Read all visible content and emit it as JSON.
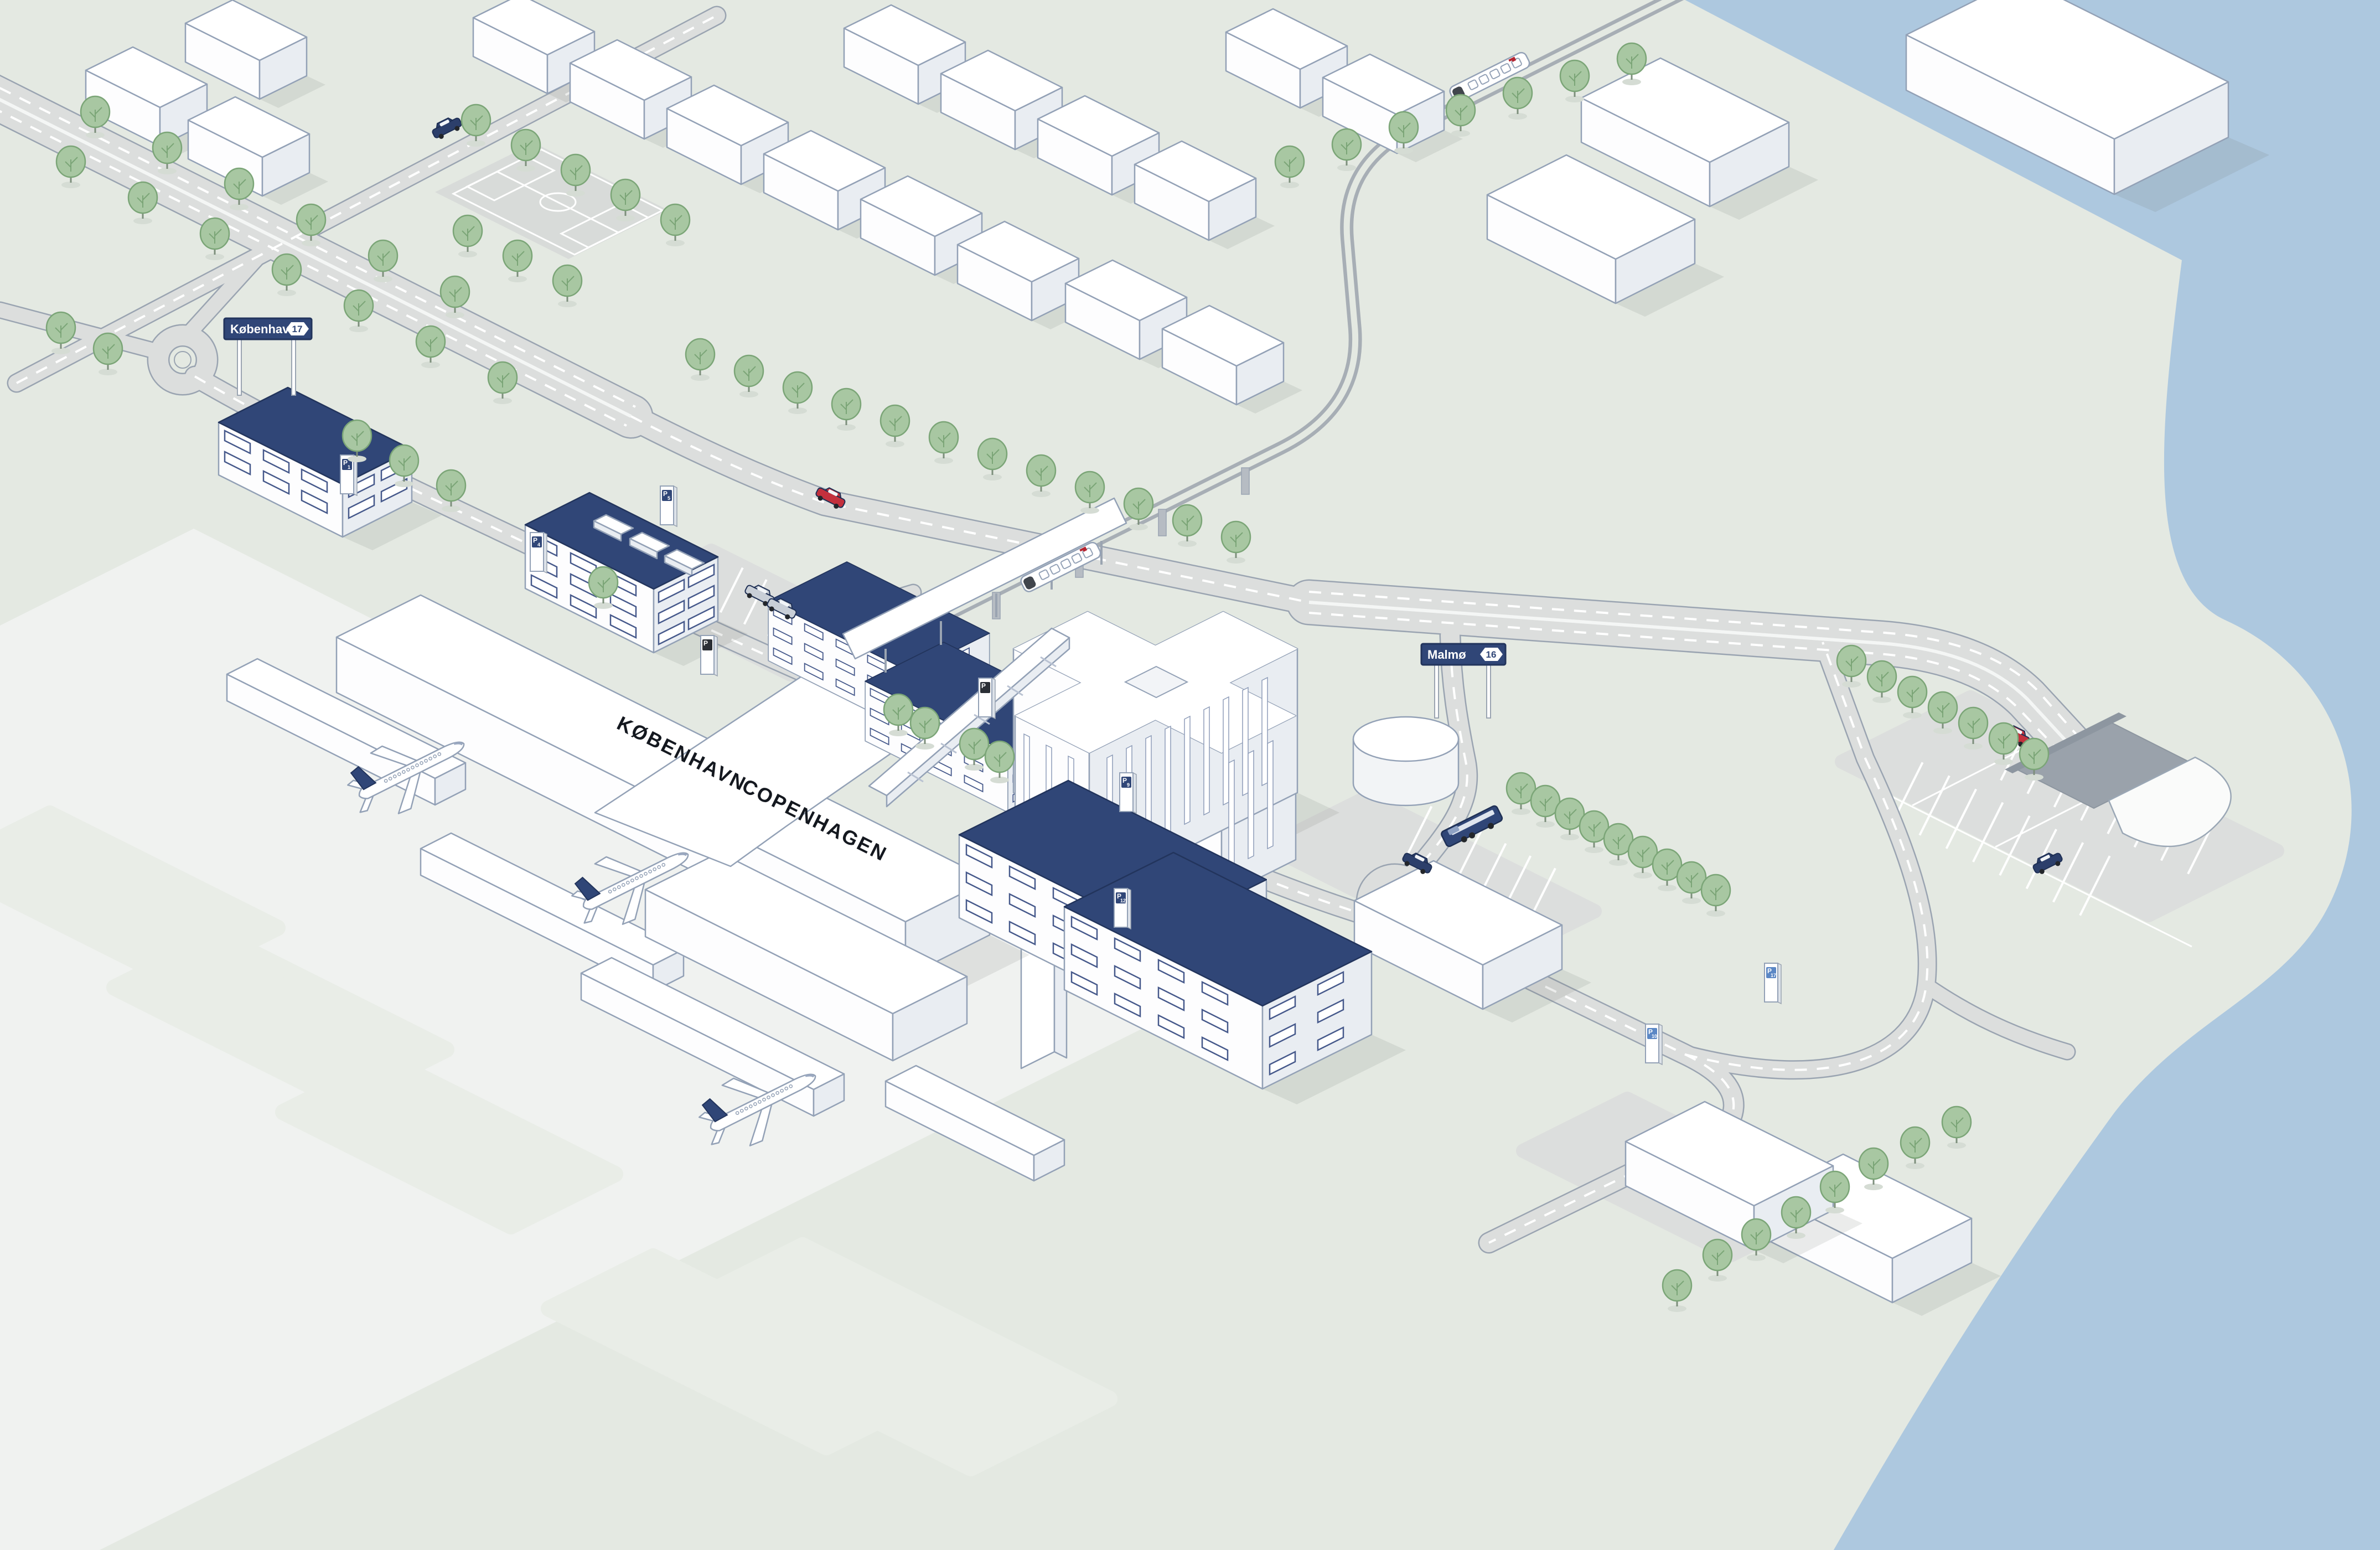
{
  "map": {
    "description": "isometric illustration of Copenhagen airport, city access roads, railway and Øresund coastline"
  },
  "terminal": {
    "label_da": "KØBENHAVN",
    "label_en": "COPENHAGEN"
  },
  "signs": {
    "kobenhavn": {
      "label": "København",
      "route": "17"
    },
    "malmo": {
      "label": "Malmø",
      "route": "16"
    }
  },
  "parking": {
    "p_label": "P",
    "pylons": [
      {
        "number": "1"
      },
      {
        "number": "4"
      },
      {
        "number": "5"
      },
      {
        "number": ""
      },
      {
        "number": "9"
      },
      {
        "number": "12"
      },
      {
        "number": "17"
      },
      {
        "number": "10"
      },
      {
        "number": ""
      }
    ]
  },
  "colors": {
    "navy": "#304677",
    "water": "#adc8df",
    "land": "#e4e9e2",
    "apron": "#f0f2f0",
    "road": "#dcdedd",
    "road_casing": "#9aa4b1",
    "tree": "#a8c7a2",
    "red_vehicle": "#c4303d"
  },
  "icons": {
    "tree": "ellipse-crown-tree",
    "airplane": "white-jet-navy-tail",
    "train": "white-railcar-red-logo",
    "bus": "navy-coach",
    "car": "isometric-car",
    "pylon": "parking-totem",
    "tank": "white-cylinder"
  }
}
